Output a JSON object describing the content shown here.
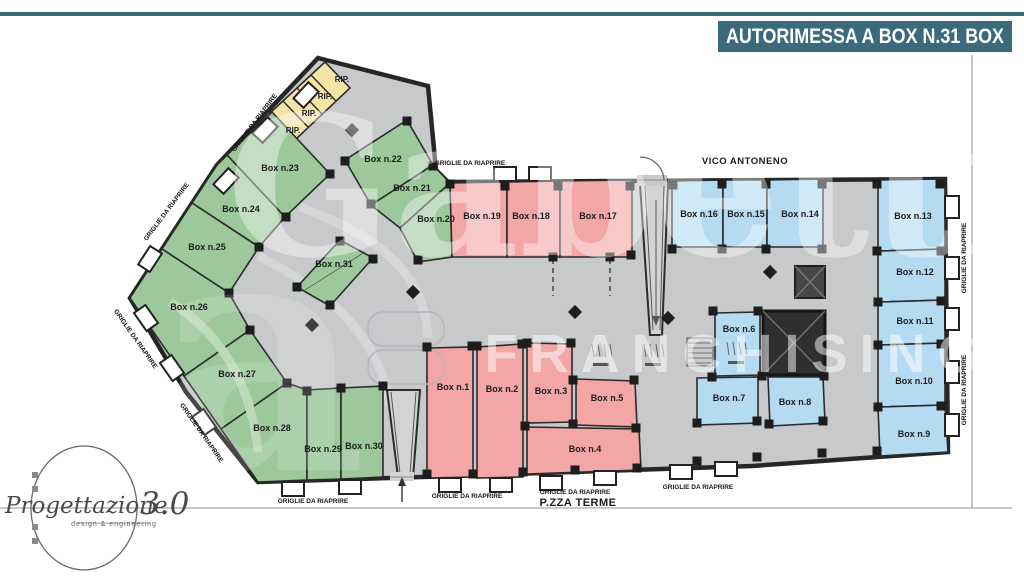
{
  "header": {
    "title": "AUTORIMESSA A BOX N.31 BOX",
    "accent_color": "#3a6a7b"
  },
  "streets": {
    "top": "VICO ANTONENO",
    "bottom": "P.ZZA TERME"
  },
  "labels": {
    "grille": "GRIGLIE DA RIAPRIRE",
    "storage": "RIP."
  },
  "watermark": {
    "brand": "Gabetti",
    "sub": "FRANCHISING",
    "letter": "a"
  },
  "logo": {
    "name": "Progettazione",
    "version": "3.0",
    "tagline": "design & engineering"
  },
  "colors": {
    "green_box": "#9cc89c",
    "pink_box": "#f3a6a6",
    "blue_box": "#b5dbf3",
    "storage_box": "#f6e3a6",
    "floor": "#c8c9cb",
    "wall": "#262626",
    "banner": "#3a6a7b"
  },
  "boxes": {
    "b1": "Box n.1",
    "b2": "Box n.2",
    "b3": "Box n.3",
    "b4": "Box n.4",
    "b5": "Box n.5",
    "b6": "Box n.6",
    "b7": "Box n.7",
    "b8": "Box n.8",
    "b9": "Box n.9",
    "b10": "Box n.10",
    "b11": "Box n.11",
    "b12": "Box n.12",
    "b13": "Box n.13",
    "b14": "Box n.14",
    "b15": "Box n.15",
    "b16": "Box n.16",
    "b17": "Box n.17",
    "b18": "Box n.18",
    "b19": "Box n.19",
    "b20": "Box n.20",
    "b21": "Box n.21",
    "b22": "Box n.22",
    "b23": "Box n.23",
    "b24": "Box n.24",
    "b25": "Box n.25",
    "b26": "Box n.26",
    "b27": "Box n.27",
    "b28": "Box n.28",
    "b29": "Box n.29",
    "b30": "Box n.30",
    "b31": "Box n.31"
  }
}
